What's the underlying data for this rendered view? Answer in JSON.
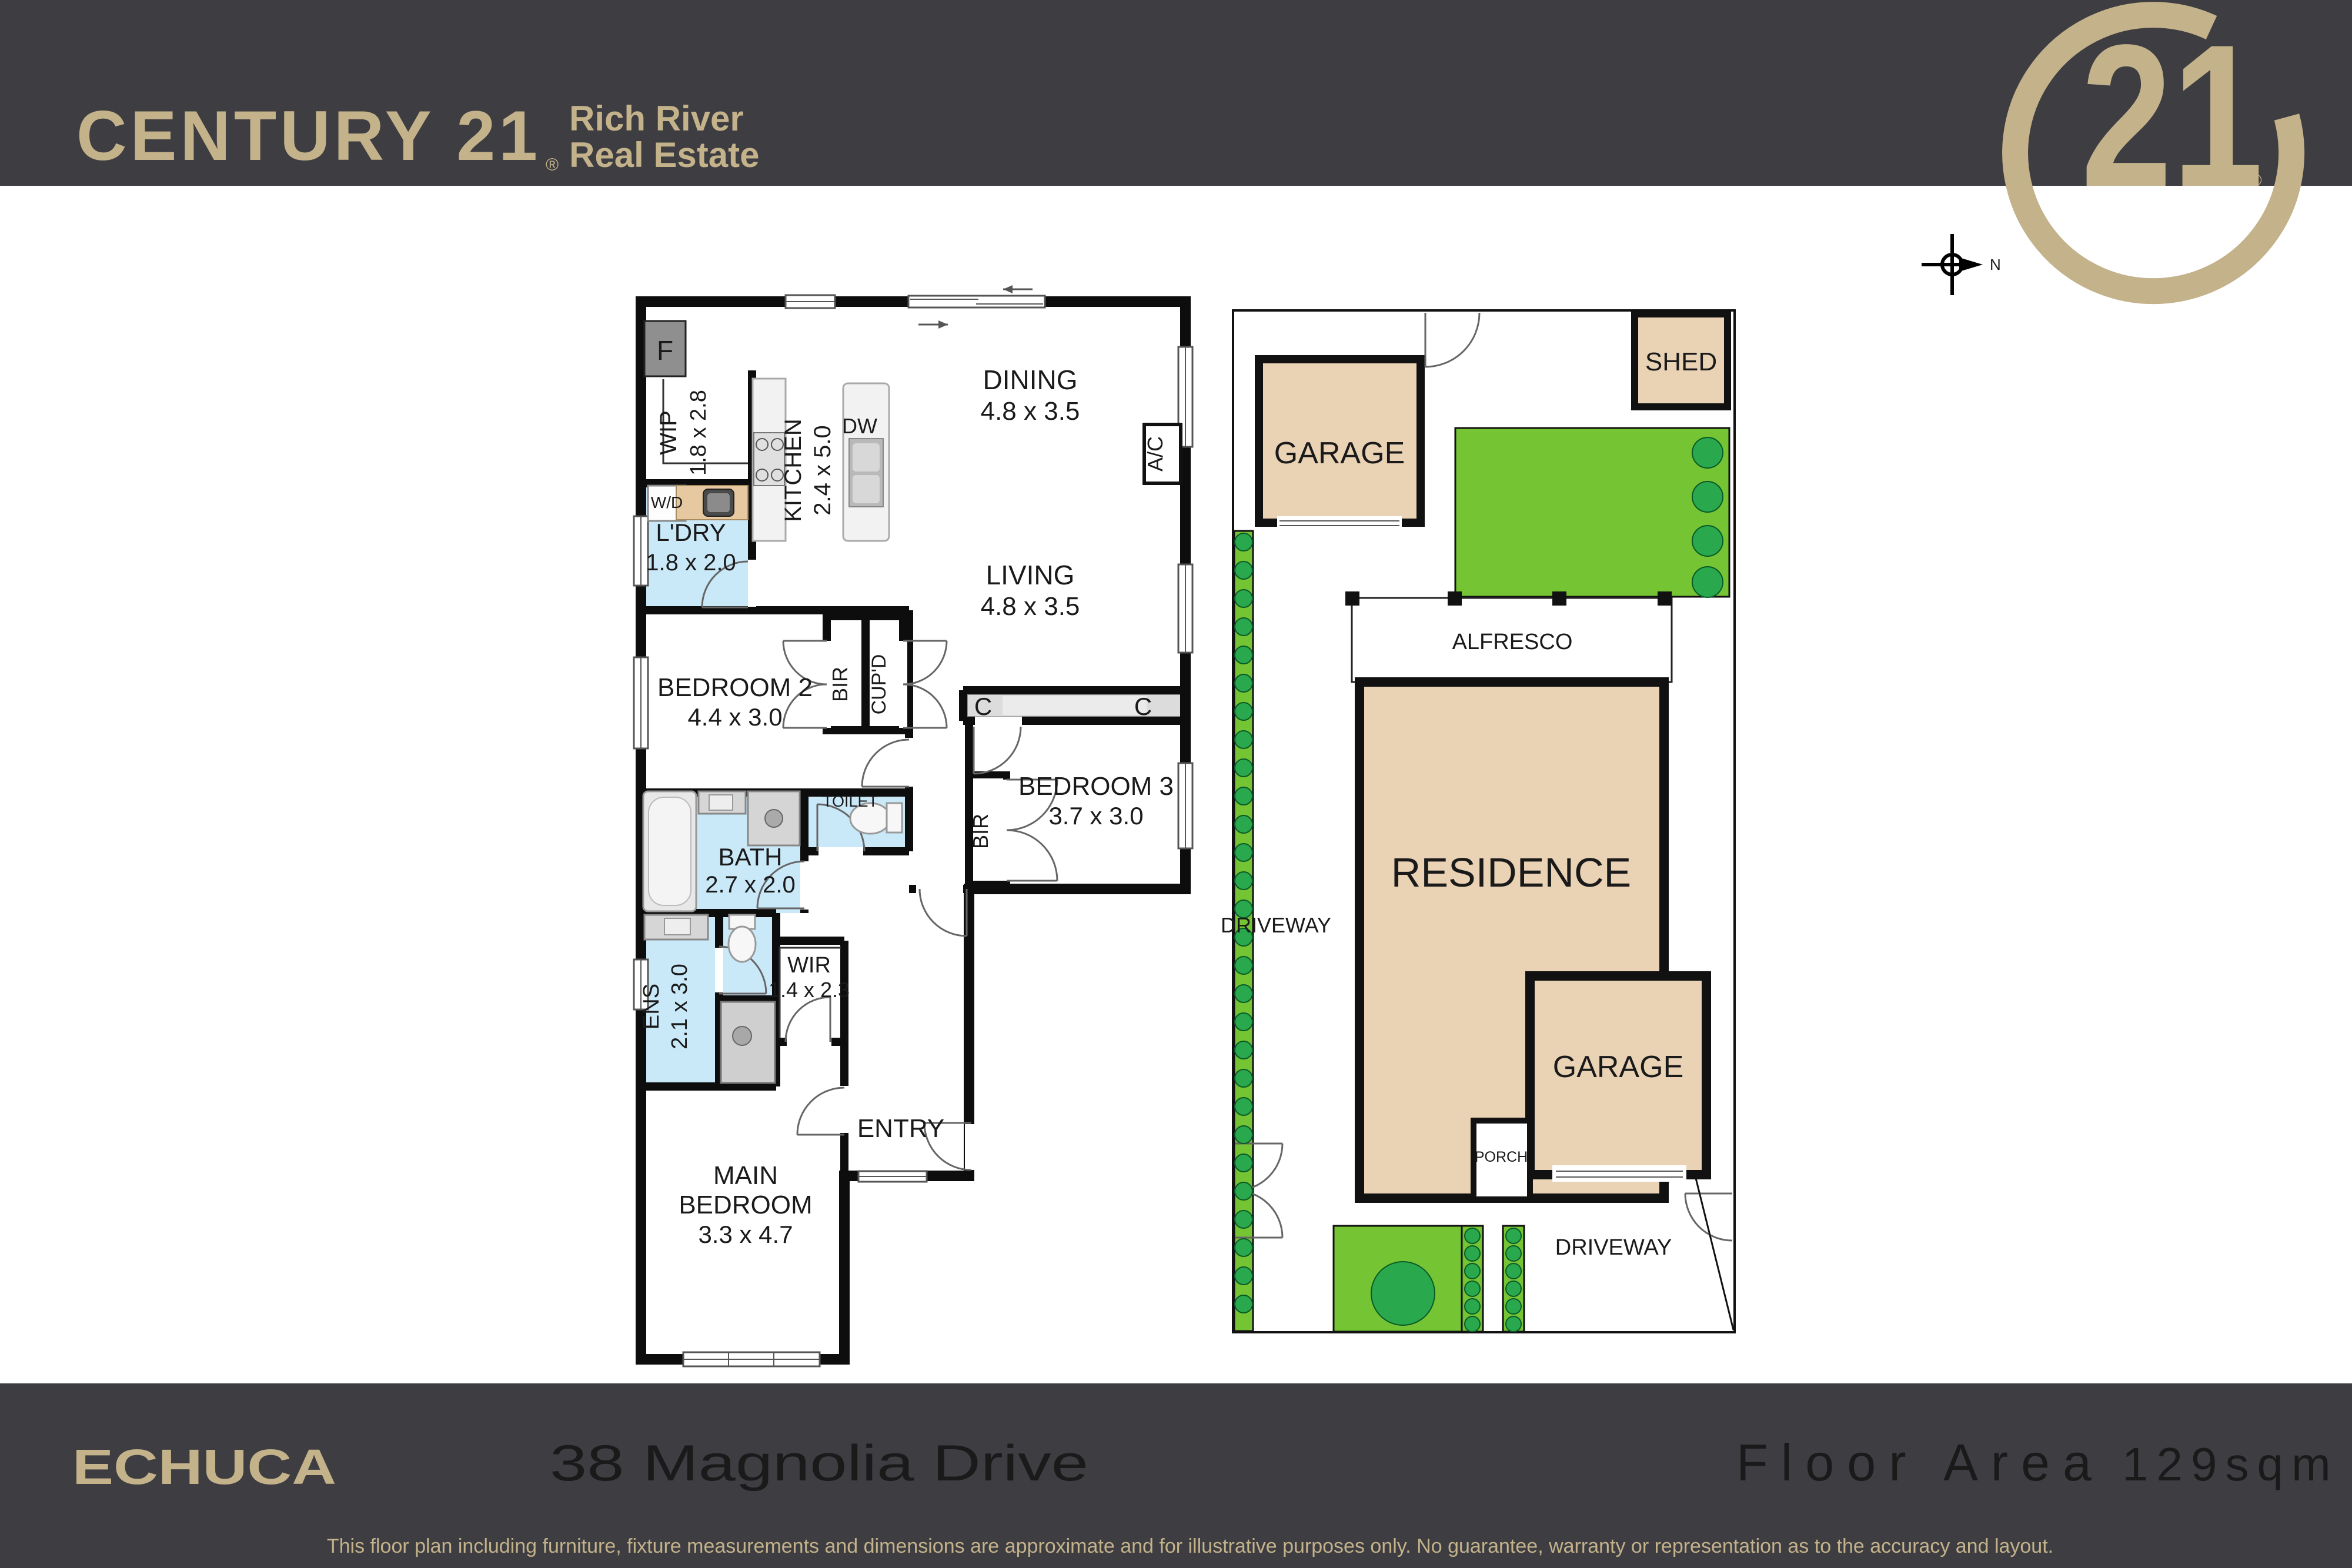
{
  "header": {
    "brand": "CENTURY 21",
    "brand_reg": "®",
    "office_line1": "Rich River",
    "office_line2": "Real Estate",
    "seal_number": "21",
    "seal_reg": "®"
  },
  "compass": {
    "north_label": "N"
  },
  "floorplan": {
    "rooms": {
      "wip": {
        "name": "WIP",
        "dims": "1.8 x 2.8"
      },
      "kitchen": {
        "name": "KITCHEN",
        "dims": "2.4 x 5.0"
      },
      "ldry": {
        "name": "L'DRY",
        "dims": "1.8 x 2.0"
      },
      "dining": {
        "name": "DINING",
        "dims": "4.8 x 3.5"
      },
      "living": {
        "name": "LIVING",
        "dims": "4.8 x 3.5"
      },
      "bedroom2": {
        "name": "BEDROOM 2",
        "dims": "4.4 x 3.0"
      },
      "bedroom3": {
        "name": "BEDROOM 3",
        "dims": "3.7 x 3.0"
      },
      "bath": {
        "name": "BATH",
        "dims": "2.7 x 2.0"
      },
      "ens": {
        "name": "ENS",
        "dims": "2.1 x 3.0"
      },
      "wir": {
        "name": "WIR",
        "dims": "1.4 x 2.3"
      },
      "main_bedroom": {
        "line1": "MAIN",
        "line2": "BEDROOM",
        "dims": "3.3 x 4.7"
      },
      "entry": {
        "name": "ENTRY"
      },
      "toilet": {
        "name": "TOILET"
      }
    },
    "fixtures": {
      "fridge": "F",
      "washer_dryer": "W/D",
      "dishwasher": "DW",
      "air_conditioner": "A/C",
      "bir": "BIR",
      "cupboard": "CUP'D",
      "bir_bed3": "BIR",
      "linen": "C"
    }
  },
  "siteplan": {
    "garage_rear": "GARAGE",
    "shed": "SHED",
    "alfresco": "ALFRESCO",
    "residence": "RESIDENCE",
    "garage_front": "GARAGE",
    "porch": "PORCH",
    "driveway_side": "DRIVEWAY",
    "driveway_front": "DRIVEWAY"
  },
  "footer": {
    "suburb": "ECHUCA",
    "address": "38 Magnolia Drive",
    "floor_area_label": "Floor Area",
    "floor_area_value": "129sqm",
    "disclaimer": "This floor plan including furniture, fixture measurements and dimensions are approximate and for illustrative purposes only. No guarantee, warranty or representation as to the accuracy and layout."
  },
  "colors": {
    "header_bg": "#3e3d42",
    "gold": "#c3b28a",
    "building_tan": "#ead2b5",
    "lawn_green": "#74c433",
    "shrub_green": "#2aa84e",
    "wet_area_blue": "#c9e8f8",
    "bench_timber": "#e6c9a0",
    "wall_black": "#0d0d0d"
  }
}
